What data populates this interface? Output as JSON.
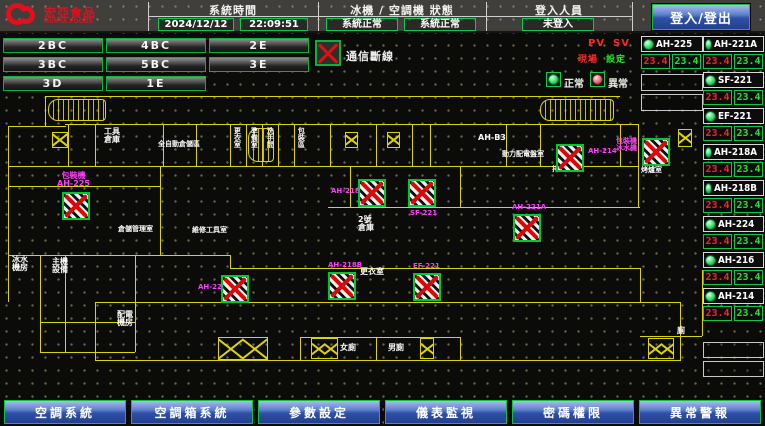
{
  "topbar": {
    "logo_line1": "宏亞食品",
    "logo_line2": "HUNYA FOODS",
    "system_time_label": "系統時間",
    "date_value": "2024/12/12",
    "time_value": "22:09:51",
    "machine_status_label": "冰機 / 空調機 狀態",
    "chiller_status": "系統正常",
    "ahu_status": "系統正常",
    "login_label": "登入人員",
    "login_status": "未登入",
    "login_button": "登入/登出"
  },
  "nav": {
    "buttons": [
      "2BC",
      "4BC",
      "2E",
      "3BC",
      "5BC",
      "3E",
      "3D",
      "1E"
    ]
  },
  "legend": {
    "comm_fail": "通信斷線",
    "pv": "PV",
    "sv": "SV",
    "pv_sub": "現場",
    "sv_sub": "設定",
    "normal": "正常",
    "abnormal": "異常"
  },
  "right_panel": {
    "col_a": {
      "units": [
        {
          "name": "AH-225",
          "pv": "23.4",
          "sv": "23.4"
        }
      ]
    },
    "col_b": {
      "units": [
        {
          "name": "AH-221A",
          "pv": "23.4",
          "sv": "23.4"
        },
        {
          "name": "SF-221",
          "pv": "23.4",
          "sv": "23.4"
        },
        {
          "name": "EF-221",
          "pv": "23.4",
          "sv": "23.4"
        },
        {
          "name": "AH-218A",
          "pv": "23.4",
          "sv": "23.4"
        },
        {
          "name": "AH-218B",
          "pv": "23.4",
          "sv": "23.4"
        },
        {
          "name": "AH-224",
          "pv": "23.4",
          "sv": "23.4"
        },
        {
          "name": "AH-216",
          "pv": "23.4",
          "sv": "23.4"
        },
        {
          "name": "AH-214",
          "pv": "23.4",
          "sv": "23.4"
        }
      ]
    }
  },
  "plan": {
    "units": [
      {
        "name": "AH-225",
        "label_lines": [
          "包裝機",
          "AH-225"
        ]
      },
      {
        "name": "AH-224",
        "label_lines": [
          "AH-224"
        ]
      },
      {
        "name": "AH-218B",
        "label_lines": [
          "AH-218B"
        ]
      },
      {
        "name": "AH-218A",
        "label_lines": [
          "AH-218A"
        ]
      },
      {
        "name": "SF-221",
        "label_lines": [
          "SF-221"
        ]
      },
      {
        "name": "EF-221",
        "label_lines": [
          "EF-221"
        ]
      },
      {
        "name": "AH-221A",
        "label_lines": [
          "AH-221A"
        ]
      },
      {
        "name": "AH-214",
        "label_lines": [
          "AH-214"
        ]
      },
      {
        "name": "unit-9",
        "label_lines": [
          "包裝機",
          "冰水機"
        ]
      }
    ],
    "rooms": {
      "tool1a": "工具",
      "tool1b": "倉庫",
      "auto_storage": "全自動倉儲區",
      "v1": "更衣室",
      "v2": "準備室",
      "v3": "洗手間",
      "v4": "包裝區",
      "ahb3": "AH-B3",
      "power": "動力配電盤室",
      "exhaust": "排風機房",
      "oven": "烤爐室",
      "wh_mgmt": "倉儲管理室",
      "repair": "維修工具室",
      "wh2a": "2號",
      "wh2b": "倉庫",
      "locker": "更衣室",
      "chw_a": "冰水",
      "chw_b": "機房",
      "host_a": "主機",
      "host_b": "設備",
      "elec_a": "配電",
      "elec_b": "機房",
      "toilet_f": "女廁",
      "toilet_m": "男廁",
      "toilet_s": "廁"
    }
  },
  "bottom_nav": {
    "buttons": [
      "空調系統",
      "空調箱系統",
      "參數設定",
      "儀表監視",
      "密碼權限",
      "異常警報"
    ]
  },
  "colors": {
    "accent_green": "#0cc84e",
    "alarm_red": "#ff2020",
    "sv_green": "#1ee81e",
    "magenta": "#ff3cff",
    "plan_yellow": "#ddd408",
    "button_blue": "#2e50a8",
    "logo_red": "#e0101e"
  }
}
